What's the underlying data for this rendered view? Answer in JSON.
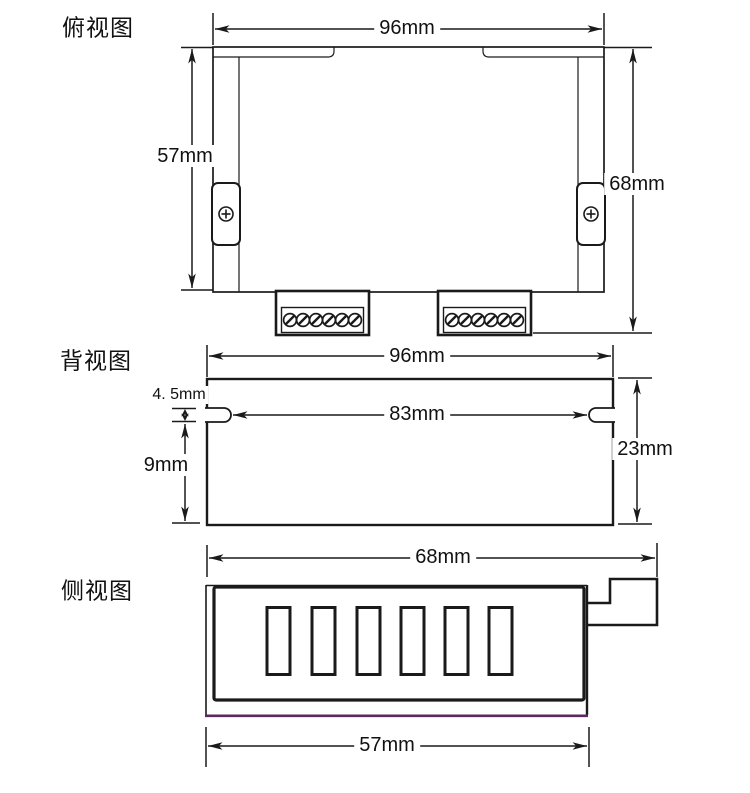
{
  "page": {
    "background": "#ffffff"
  },
  "colors": {
    "line": "#1a1a1a",
    "base_accent": "#5c2a5c"
  },
  "views": {
    "top_view": {
      "label": "俯视图",
      "dims": {
        "width": "96mm",
        "body_depth": "57mm",
        "overall_depth": "68mm"
      }
    },
    "back_view": {
      "label": "背视图",
      "dims": {
        "width": "96mm",
        "slot_height": "4. 5mm",
        "slot_bottom_offset": "9mm",
        "slot_span": "83mm",
        "height": "23mm"
      }
    },
    "side_view": {
      "label": "侧视图",
      "dims": {
        "overall_width": "68mm",
        "body_width": "57mm"
      }
    }
  }
}
